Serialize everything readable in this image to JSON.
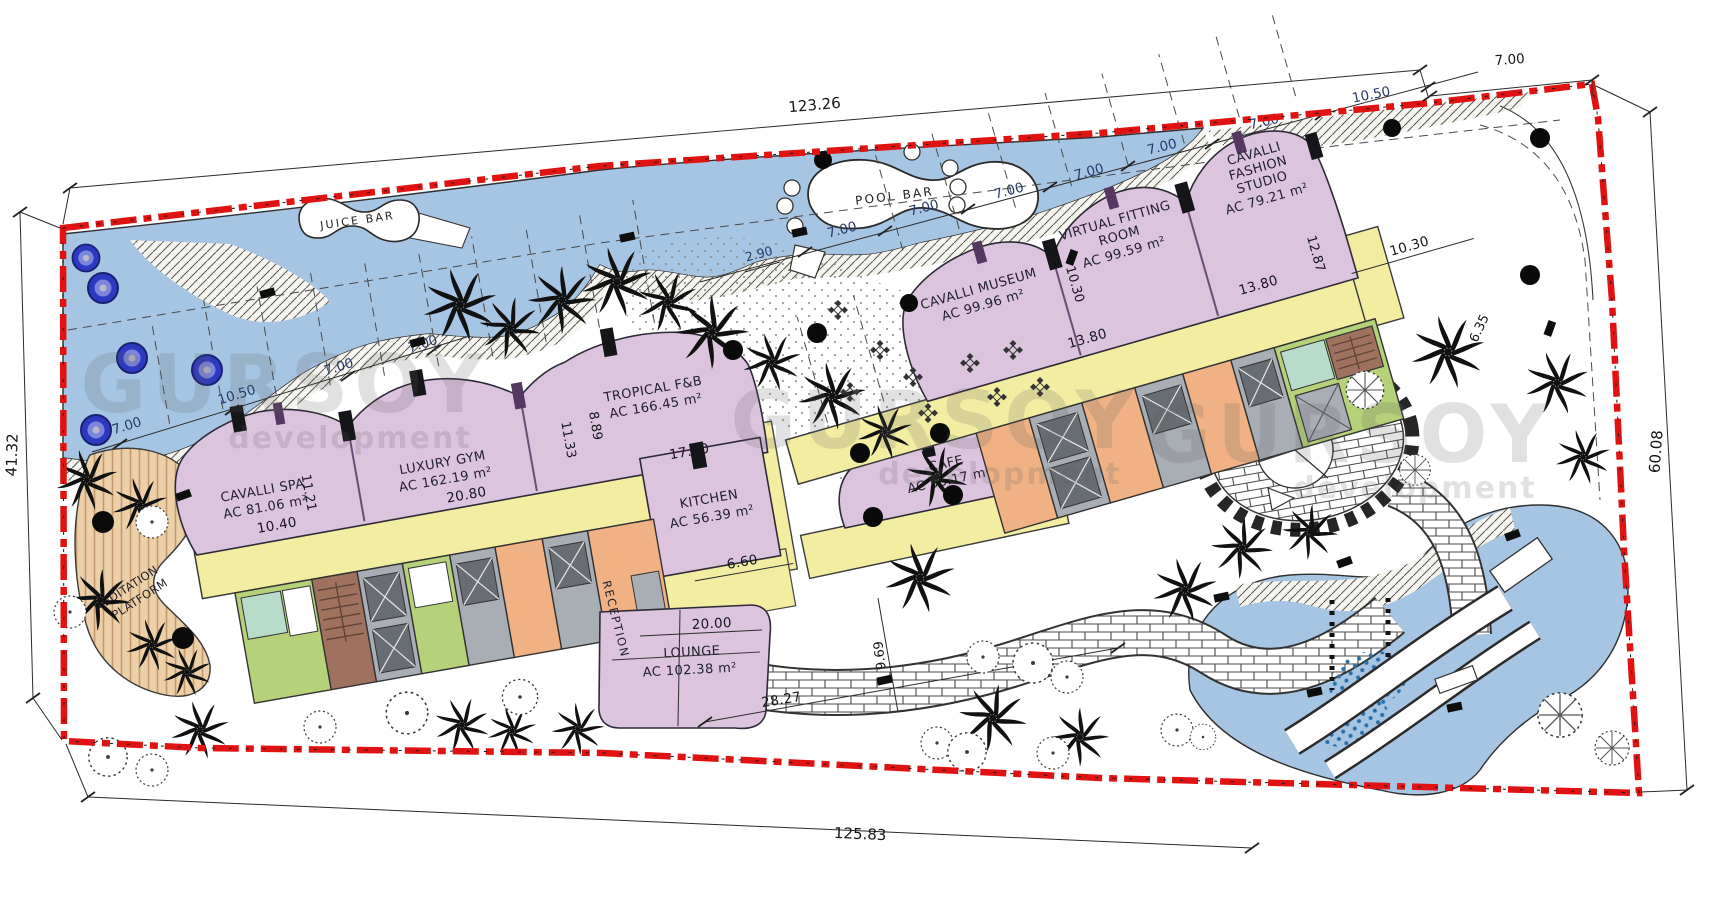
{
  "plan_labels": {
    "juice_bar": {
      "name": "JUICE BAR"
    },
    "pool_bar": {
      "name": "POOL BAR"
    },
    "cavalli_spa": {
      "name": "CAVALLI SPA",
      "area": "AC 81.06 m²"
    },
    "luxury_gym": {
      "name": "LUXURY GYM",
      "area": "AC 162.19 m²"
    },
    "tropical_fb": {
      "name": "TROPICAL F&B",
      "area": "AC 166.45 m²"
    },
    "kitchen": {
      "name": "KITCHEN",
      "area": "AC 56.39 m²"
    },
    "cafe": {
      "name": "CAFE",
      "area": "AC 56.17 m²"
    },
    "lounge": {
      "name": "LOUNGE",
      "area": "AC 102.38 m²"
    },
    "reception": {
      "name": "RECEPTION"
    },
    "cavalli_museum": {
      "name": "CAVALLI MUSEUM",
      "area": "AC 99.96 m²"
    },
    "virtual_fitting_room": {
      "line1": "VIRTUAL FITTING",
      "line2": "ROOM",
      "area": "AC 99.59 m²"
    },
    "cavalli_fashion_studio": {
      "line1": "CAVALLI",
      "line2": "FASHION",
      "line3": "STUDIO",
      "area": "AC 79.21 m²"
    },
    "meditation_platform": {
      "line1": "MEDITATION",
      "line2": "PLATFORM"
    }
  },
  "dimensions": {
    "plot_top": "123.26",
    "plot_left": "41.32",
    "plot_bottom": "125.83",
    "plot_right": "60.08",
    "grid_7": "7.00",
    "grid_10_50": "10.50",
    "grid_2_90": "2.90",
    "spa_width": "10.40",
    "spa_depth": "11.21",
    "gym_width": "20.80",
    "gym_depth": "11.33",
    "fb_depth": "8.89",
    "fb_width": "17.30",
    "kitchen_width": "6.60",
    "lounge_width": "20.00",
    "lounge_diag": "28.27",
    "path_width": "9.69",
    "unit_13_80": "13.80",
    "museum_depth": "10.30",
    "fashion_width": "10.30",
    "fashion_depth": "12.87",
    "rooms_width": "6.35"
  },
  "watermark": {
    "line1": "GURSOY",
    "line2": "development"
  },
  "colors": {
    "boundary_red": "#e01212",
    "water_blue": "#a6c5e2",
    "building_pink": "#dcc3de",
    "corridor_yellow": "#f3eda2",
    "room_green": "#b5d17a",
    "room_orange": "#f0b285",
    "room_gray": "#a9aeb5",
    "stair_brown": "#9f7260",
    "deck_tan": "#ecd0a9"
  }
}
